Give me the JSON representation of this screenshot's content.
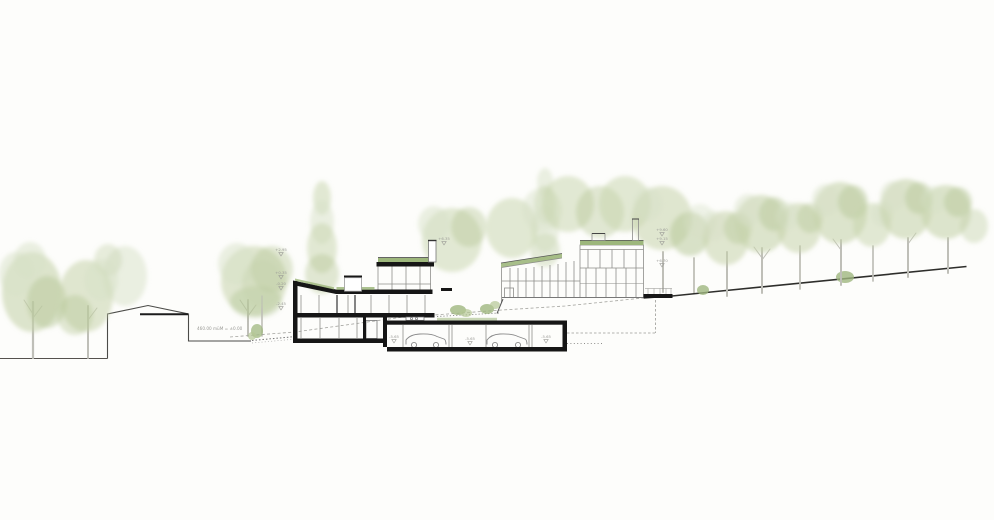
{
  "document": {
    "type": "architectural-section-drawing",
    "description": "Hillside cross-section of terraced residential buildings with underground garage and trees"
  },
  "palette": {
    "background": "#fdfdfb",
    "cut_black": "#161616",
    "line_gray": "#8f8f8c",
    "dark_line": "#2e2e2b",
    "dashed_gray": "#a3a39e",
    "green_roof": "#9db77c",
    "trunk": "#bfbfb8",
    "annotation_gray": "#9a9a96",
    "foliage": {
      "f1": "#d8e1c8",
      "f2": "#c6d3ac",
      "f3": "#b4c694",
      "f4": "#9fb77f"
    }
  },
  "annotations": {
    "datum": "460.00 müM = ±0.00",
    "markers": [
      {
        "x": 281,
        "y": 251,
        "label": "+2.95"
      },
      {
        "x": 281,
        "y": 274,
        "label": "+0.35"
      },
      {
        "x": 281,
        "y": 285,
        "label": "-0.20"
      },
      {
        "x": 281,
        "y": 305,
        "label": "-2.45"
      },
      {
        "x": 394,
        "y": 338,
        "label": "-5.65"
      },
      {
        "x": 470,
        "y": 340,
        "label": "-5.65"
      },
      {
        "x": 546,
        "y": 338,
        "label": "-5.65"
      },
      {
        "x": 444,
        "y": 240,
        "label": "+6.35"
      },
      {
        "x": 662,
        "y": 231,
        "label": "+9.60"
      },
      {
        "x": 662,
        "y": 240,
        "label": "+9.15"
      },
      {
        "x": 662,
        "y": 262,
        "label": "+6.70"
      }
    ]
  },
  "vegetation": {
    "trees": [
      {
        "layer": "back",
        "canopy": [
          [
            322,
            198,
            9,
            17,
            "f2",
            0.5
          ],
          [
            322,
            222,
            12,
            22,
            "f1",
            0.5
          ],
          [
            322,
            248,
            15,
            25,
            "f2",
            0.5
          ],
          [
            322,
            274,
            17,
            20,
            "f3",
            0.4
          ]
        ]
      },
      {
        "layer": "back",
        "canopy": [
          [
            452,
            240,
            30,
            32,
            "f2",
            0.5
          ],
          [
            434,
            224,
            16,
            18,
            "f1",
            0.5
          ],
          [
            469,
            227,
            18,
            20,
            "f3",
            0.4
          ]
        ]
      },
      {
        "layer": "back",
        "canopy": [
          [
            545,
            182,
            8,
            14,
            "f1",
            0.5
          ],
          [
            545,
            205,
            11,
            19,
            "f2",
            0.5
          ],
          [
            545,
            229,
            14,
            23,
            "f1",
            0.5
          ],
          [
            545,
            250,
            15,
            17,
            "f2",
            0.45
          ]
        ]
      },
      {
        "layer": "back",
        "canopy": [
          [
            512,
            228,
            26,
            30,
            "f2",
            0.5
          ],
          [
            542,
            210,
            20,
            22,
            "f1",
            0.45
          ]
        ]
      },
      {
        "layer": "back",
        "canopy": [
          [
            568,
            204,
            26,
            28,
            "f2",
            0.5
          ],
          [
            600,
            212,
            24,
            26,
            "f3",
            0.4
          ]
        ]
      },
      {
        "layer": "back",
        "canopy": [
          [
            625,
            204,
            26,
            28,
            "f2",
            0.5
          ]
        ]
      },
      {
        "layer": "back",
        "trunk": [
          663,
          292,
          252,
          2
        ],
        "canopy": [
          [
            662,
            218,
            30,
            32,
            "f2",
            0.55
          ],
          [
            648,
            204,
            15,
            17,
            "f1",
            0.4
          ]
        ]
      },
      {
        "layer": "back",
        "trunk": [
          694,
          293,
          258,
          1.8
        ],
        "canopy": [
          [
            690,
            234,
            20,
            22,
            "f3",
            0.5
          ],
          [
            700,
            222,
            16,
            18,
            "f1",
            0.4
          ]
        ]
      },
      {
        "layer": "back",
        "canopy": [
          [
            125,
            276,
            22,
            30,
            "f1",
            0.5
          ],
          [
            108,
            260,
            14,
            16,
            "f2",
            0.4
          ]
        ]
      },
      {
        "layer": "back",
        "trunk": [
          248,
          336,
          300,
          2
        ],
        "branches": [
          "M248,312 L240,300",
          "M248,316 L256,305"
        ],
        "canopy": [
          [
            254,
            281,
            33,
            35,
            "f2",
            0.55
          ],
          [
            237,
            264,
            19,
            21,
            "f1",
            0.5
          ],
          [
            272,
            269,
            21,
            23,
            "f3",
            0.4
          ],
          [
            256,
            302,
            26,
            16,
            "f4",
            0.3
          ]
        ]
      },
      {
        "layer": "back",
        "trunk": [
          262,
          336,
          296,
          1.6
        ],
        "canopy": [
          [
            262,
            284,
            20,
            24,
            "f2",
            0.4
          ]
        ]
      },
      {
        "layer": "front",
        "trunk": [
          33,
          358,
          302,
          2.2
        ],
        "branches": [
          "M33,314 L24,300",
          "M33,318 L42,306"
        ],
        "canopy": [
          [
            32,
            292,
            30,
            40,
            "f2",
            0.6
          ],
          [
            16,
            274,
            17,
            22,
            "f1",
            0.5
          ],
          [
            47,
            302,
            20,
            26,
            "f3",
            0.45
          ],
          [
            30,
            260,
            16,
            18,
            "f1",
            0.5
          ]
        ]
      },
      {
        "layer": "front",
        "trunk": [
          88,
          358,
          306,
          2
        ],
        "branches": [
          "M88,320 L97,308"
        ],
        "canopy": [
          [
            86,
            296,
            27,
            36,
            "f2",
            0.55
          ],
          [
            101,
            280,
            17,
            21,
            "f1",
            0.5
          ],
          [
            75,
            315,
            18,
            20,
            "f3",
            0.4
          ]
        ]
      },
      {
        "layer": "front",
        "trunk": [
          727,
          296,
          252,
          2
        ],
        "canopy": [
          [
            726,
            238,
            23,
            27,
            "f2",
            0.55
          ],
          [
            714,
            226,
            13,
            15,
            "f1",
            0.45
          ],
          [
            738,
            228,
            14,
            16,
            "f3",
            0.4
          ]
        ]
      },
      {
        "layer": "front",
        "trunk": [
          762,
          293,
          248,
          2
        ],
        "branches": [
          "M762,258 L754,247",
          "M762,260 L770,249"
        ],
        "canopy": [
          [
            761,
            224,
            26,
            29,
            "f2",
            0.6
          ],
          [
            748,
            210,
            14,
            16,
            "f1",
            0.45
          ],
          [
            774,
            214,
            15,
            17,
            "f3",
            0.45
          ]
        ]
      },
      {
        "layer": "front",
        "trunk": [
          800,
          289,
          246,
          1.8
        ],
        "canopy": [
          [
            799,
            228,
            22,
            25,
            "f2",
            0.55
          ],
          [
            788,
            216,
            12,
            14,
            "f1",
            0.4
          ],
          [
            810,
            218,
            13,
            15,
            "f3",
            0.4
          ]
        ]
      },
      {
        "layer": "front",
        "trunk": [
          841,
          285,
          240,
          2
        ],
        "branches": [
          "M841,250 L833,239"
        ],
        "canopy": [
          [
            840,
            213,
            27,
            31,
            "f2",
            0.6
          ],
          [
            826,
            200,
            14,
            16,
            "f1",
            0.45
          ],
          [
            853,
            202,
            15,
            17,
            "f3",
            0.45
          ]
        ]
      },
      {
        "layer": "front",
        "trunk": [
          873,
          281,
          246,
          1.7
        ],
        "canopy": [
          [
            872,
            225,
            19,
            22,
            "f2",
            0.5
          ],
          [
            882,
            214,
            11,
            13,
            "f1",
            0.4
          ]
        ]
      },
      {
        "layer": "front",
        "trunk": [
          908,
          277,
          238,
          2
        ],
        "branches": [
          "M908,244 L916,233"
        ],
        "canopy": [
          [
            906,
            209,
            26,
            30,
            "f2",
            0.6
          ],
          [
            893,
            196,
            13,
            15,
            "f1",
            0.45
          ],
          [
            919,
            198,
            14,
            16,
            "f3",
            0.45
          ]
        ]
      },
      {
        "layer": "front",
        "trunk": [
          948,
          273,
          238,
          2
        ],
        "canopy": [
          [
            946,
            212,
            25,
            27,
            "f2",
            0.6
          ],
          [
            934,
            200,
            13,
            14,
            "f1",
            0.4
          ],
          [
            958,
            202,
            14,
            15,
            "f3",
            0.45
          ],
          [
            974,
            226,
            14,
            17,
            "f2",
            0.45
          ]
        ]
      }
    ],
    "bushes": [
      [
        845,
        277,
        9,
        6,
        "f4",
        0.8
      ],
      [
        703,
        290,
        6,
        5,
        "f4",
        0.8
      ],
      [
        257,
        331,
        6,
        7,
        "f4",
        0.75
      ],
      [
        252,
        336,
        4,
        4,
        "f3",
        0.7
      ],
      [
        458,
        310,
        8,
        5,
        "f4",
        0.8
      ],
      [
        466,
        313,
        6,
        4,
        "f3",
        0.7
      ],
      [
        487,
        309,
        7,
        5,
        "f4",
        0.8
      ],
      [
        495,
        305,
        5,
        4,
        "f3",
        0.7
      ]
    ]
  }
}
